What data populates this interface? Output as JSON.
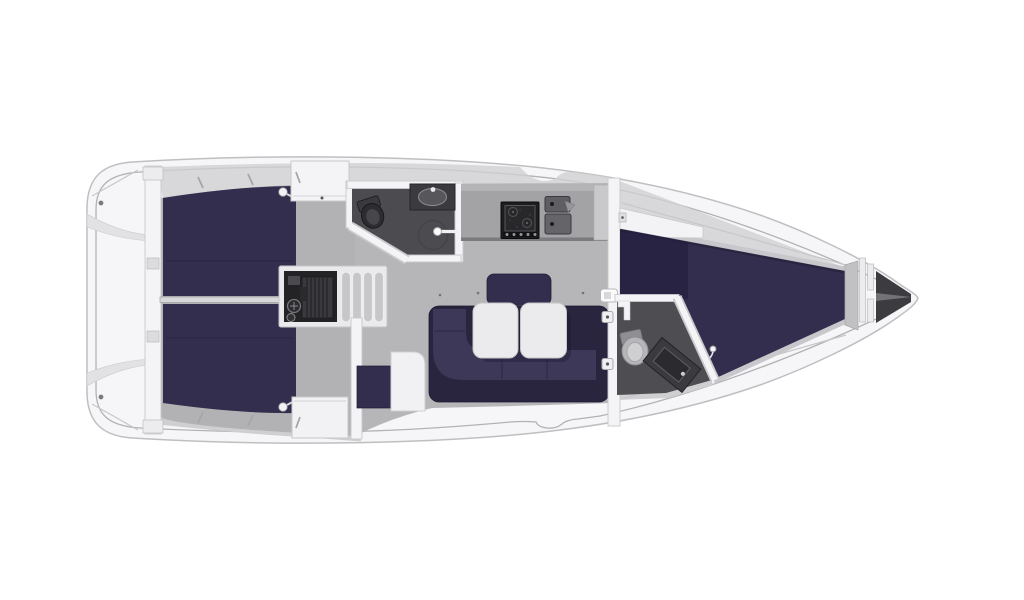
{
  "diagram": {
    "type": "floor-plan",
    "subject": "sailing-yacht-interior-top-view",
    "orientation": "bow-right",
    "rooms": [
      {
        "id": "aft-deck",
        "name": "aft deck / transom platform"
      },
      {
        "id": "aft-cabin-port",
        "name": "aft cabin double berth (upper)"
      },
      {
        "id": "aft-cabin-starboard",
        "name": "aft cabin double berth (lower)"
      },
      {
        "id": "engine-compartment",
        "name": "engine compartment"
      },
      {
        "id": "companionway-steps",
        "name": "companionway steps"
      },
      {
        "id": "aft-head",
        "name": "aft head with toilet, washbasin and shower"
      },
      {
        "id": "galley",
        "name": "galley with stove and double sink"
      },
      {
        "id": "saloon",
        "name": "saloon with U-settee and folding table"
      },
      {
        "id": "nav-seat",
        "name": "seat unit beside saloon"
      },
      {
        "id": "forward-head",
        "name": "forward head with toilet and vanity sink"
      },
      {
        "id": "forward-cabin",
        "name": "forward cabin V-berth"
      },
      {
        "id": "anchor-locker",
        "name": "anchor locker at bow"
      }
    ],
    "fixtures": [
      "toilet",
      "washbasin",
      "shower",
      "stove",
      "double-sink",
      "wardrobe",
      "table-leaf",
      "step-tread",
      "berth-cushion",
      "engine",
      "footboard"
    ]
  },
  "colors": {
    "page_bg": "#ffffff",
    "hull": "#f6f6f8",
    "hull_outline": "#bfbfc2",
    "deck_shadow": "#cfcfd2",
    "floor": "#b6b6b8",
    "floor_aft": "#b2b2b4",
    "upholstery": "#332e4d",
    "upholstery_dark": "#2a253f",
    "upholstery_light": "#3d3758",
    "wetroom_floor": "#4c4c50",
    "wetroom_floor_fwd": "#4e4e52",
    "counter": "#a3a3a6",
    "appliance_dark": "#1d1d1f",
    "engine": "#232326",
    "steps": "#c7c7c9",
    "table": "#ebebed",
    "toilet_light": "#b6b6b9",
    "vanity_dark": "#3a3a3f",
    "anchor_locker": "#3c3c40",
    "wall": "#f4f4f6",
    "wall_outline": "#c9c9cc"
  }
}
